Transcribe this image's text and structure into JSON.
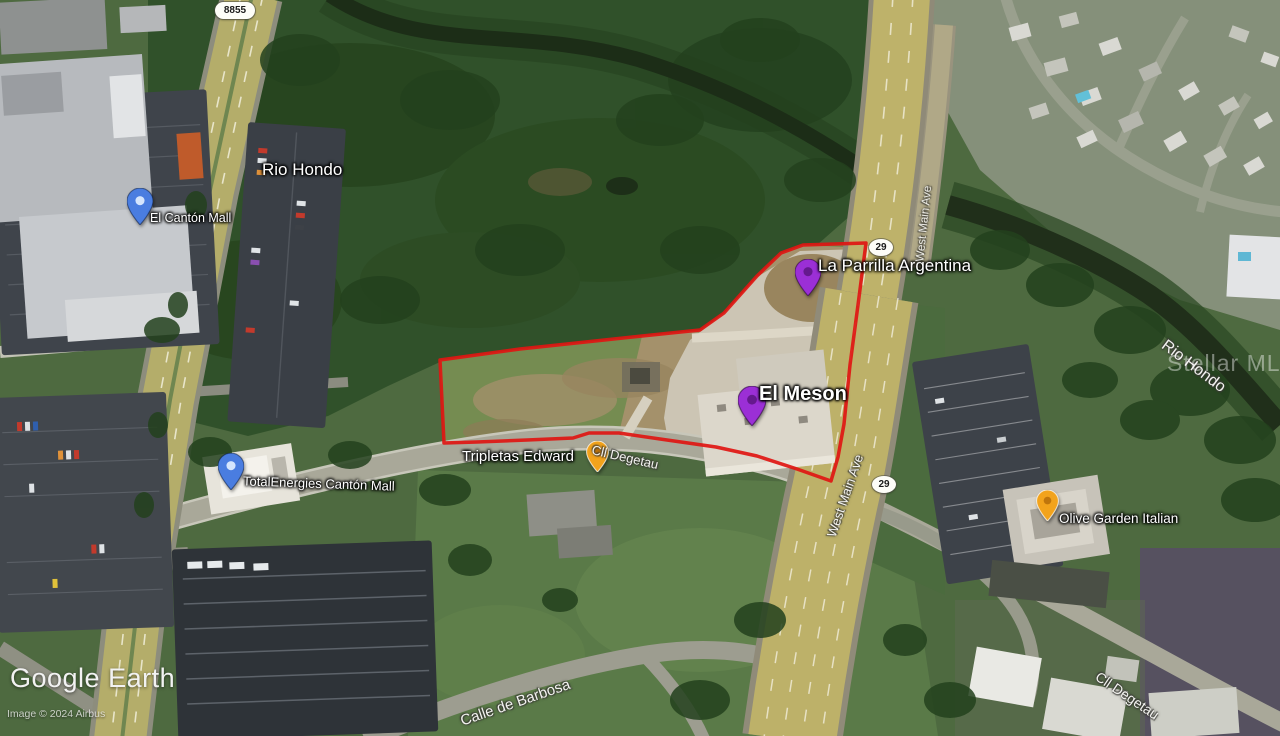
{
  "branding": {
    "logo": "Google Earth",
    "copyright": "Image © 2024 Airbus",
    "watermark": "Stellar MLS"
  },
  "colors": {
    "parcel_outline": "#e01612",
    "pin_purple": "#9b2fd6",
    "pin_orange": "#f2a31c",
    "pin_blue": "#4a7de0"
  },
  "overlay": {
    "parcel_points": "440,360 520,349 642,336 700,330 724,313 757,276 781,253 803,245 866,243 858,305 850,365 844,424 838,457 831,481 797,469 757,456 716,447 667,440 619,433 589,433 573,438 527,440 477,442 444,443"
  },
  "place_labels": [
    {
      "text": "Rio Hondo"
    },
    {
      "text": "El Cantón Mall"
    },
    {
      "text": "La Parrilla Argentina"
    },
    {
      "text": "El Meson"
    },
    {
      "text": "Tripletas Edward"
    },
    {
      "text": "TotalEnergies Cantón Mall"
    },
    {
      "text": "Olive Garden Italian"
    }
  ],
  "road_labels": [
    {
      "text": "Cll Degetau"
    },
    {
      "text": "West Main Ave"
    },
    {
      "text": "West Main Ave"
    },
    {
      "text": "Rio Hondo"
    },
    {
      "text": "Calle de Barbosa"
    },
    {
      "text": "Cll Degetau"
    }
  ],
  "route_shields": [
    {
      "text": "8855"
    },
    {
      "text": "29"
    },
    {
      "text": "29"
    }
  ],
  "pins": [
    {
      "name": "El Cantón Mall",
      "color_key": "pin_blue"
    },
    {
      "name": "TotalEnergies Cantón Mall",
      "color_key": "pin_blue"
    },
    {
      "name": "La Parrilla Argentina",
      "color_key": "pin_purple"
    },
    {
      "name": "El Meson",
      "color_key": "pin_purple"
    },
    {
      "name": "Tripletas Edward",
      "color_key": "pin_orange"
    },
    {
      "name": "Olive Garden Italian",
      "color_key": "pin_orange"
    }
  ]
}
